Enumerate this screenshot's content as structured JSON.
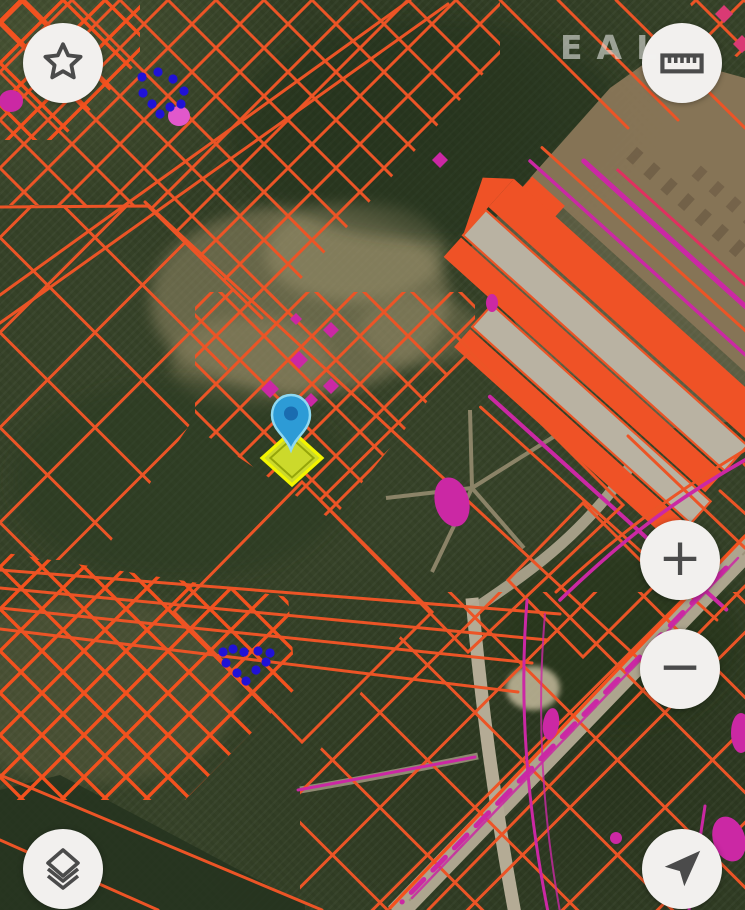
{
  "app": {
    "name": "cadastral-map-view",
    "view": "satellite-with-parcel-overlay"
  },
  "watermark": {
    "text": "EAL"
  },
  "controls": {
    "favorites": {
      "icon": "star-icon"
    },
    "measure": {
      "icon": "ruler-icon"
    },
    "zoom_in": {
      "label": "+"
    },
    "zoom_out": {
      "label": "−"
    },
    "layers": {
      "icon": "layers-icon"
    },
    "compass": {
      "icon": "navigation-arrow-icon"
    }
  },
  "map": {
    "marker": {
      "name": "location-pin",
      "x": 291,
      "y": 450
    },
    "selected_parcel": {
      "shape": "diamond",
      "cx": 292,
      "cy": 458,
      "half_w": 30,
      "half_h": 27
    },
    "vertex_clusters": [
      {
        "id": "north-cluster",
        "points": [
          [
            142,
            77
          ],
          [
            158,
            72
          ],
          [
            173,
            79
          ],
          [
            184,
            91
          ],
          [
            181,
            104
          ],
          [
            170,
            107
          ],
          [
            160,
            114
          ],
          [
            152,
            104
          ],
          [
            143,
            93
          ]
        ]
      },
      {
        "id": "south-cluster",
        "points": [
          [
            223,
            652
          ],
          [
            233,
            649
          ],
          [
            244,
            652
          ],
          [
            258,
            651
          ],
          [
            270,
            653
          ],
          [
            226,
            663
          ],
          [
            237,
            673
          ],
          [
            246,
            681
          ],
          [
            256,
            670
          ],
          [
            266,
            662
          ]
        ]
      }
    ],
    "colors": {
      "parcel-line": "#ec5426",
      "parcel-line-bright": "#f4511e",
      "zone-magenta": "#cb28a4",
      "zone-pink": "#e158cb",
      "building-fill": "#ef5226",
      "building-roof": "#b9b2a2",
      "pin-fill": "#2d9bd6",
      "pin-stroke": "#8fd9f2",
      "pin-hole": "#1a6cb0",
      "selected-fill": "#ccd92b",
      "selected-stroke": "#f2f500",
      "vertex-dot": "#2012d6",
      "button-bg": "#f2f0ee",
      "button-icon": "#4b4b4b"
    }
  }
}
